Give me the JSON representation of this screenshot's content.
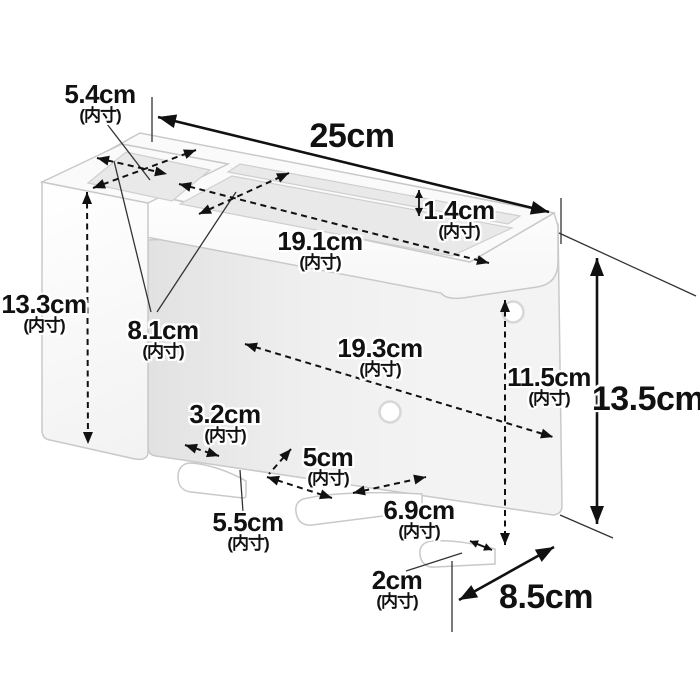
{
  "diagram": {
    "description": "wall-mount organizer dimension line drawing",
    "unit_suffix": "(内寸)",
    "colors": {
      "dimension_line": "#111111",
      "product_stroke": "#c9c9c9",
      "product_fill": "#ffffff",
      "panel_fill": "#f0f0f0",
      "opening_fill": "#e9e9e9"
    },
    "dimensions": {
      "overall_width": {
        "value": "25cm",
        "note": ""
      },
      "overall_height": {
        "value": "13.5cm",
        "note": ""
      },
      "overall_depth": {
        "value": "8.5cm",
        "note": ""
      },
      "left_box_width": {
        "value": "5.4cm",
        "note": "(内寸)"
      },
      "left_box_height": {
        "value": "13.3cm",
        "note": "(内寸)"
      },
      "tray_inner_width": {
        "value": "19.1cm",
        "note": "(内寸)"
      },
      "tray_inner_depth": {
        "value": "8.1cm",
        "note": "(内寸)"
      },
      "rear_slot_depth": {
        "value": "1.4cm",
        "note": "(内寸)"
      },
      "lower_inner_width": {
        "value": "19.3cm",
        "note": "(内寸)"
      },
      "lower_inner_height": {
        "value": "11.5cm",
        "note": "(内寸)"
      },
      "hook_gap_left": {
        "value": "3.2cm",
        "note": "(内寸)"
      },
      "hook_gap_middle": {
        "value": "5cm",
        "note": "(内寸)"
      },
      "hook_gap_right": {
        "value": "6.9cm",
        "note": "(内寸)"
      },
      "hook_inner_length": {
        "value": "5.5cm",
        "note": "(内寸)"
      },
      "hook_tip_width": {
        "value": "2cm",
        "note": "(内寸)"
      }
    }
  }
}
